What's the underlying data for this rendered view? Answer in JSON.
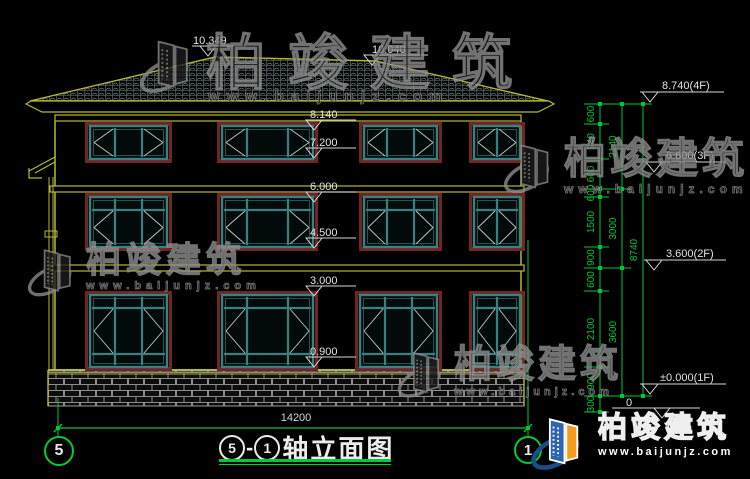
{
  "brand": {
    "name": "柏竣建筑",
    "url": "www.baijunjz.com"
  },
  "title": {
    "axis_from": "5",
    "dash": "-",
    "axis_to": "1",
    "name": "轴立面图"
  },
  "axes": {
    "left_label": "5",
    "right_label": "1"
  },
  "bottom_dim": {
    "label": "14200"
  },
  "figure": {
    "colors": {
      "yellow": "#b8b832",
      "teal": "#3a8080",
      "teal_dark": "#235555",
      "red": "#722323",
      "green": "#00c832",
      "white": "#d8d8d8",
      "text": "#e2e2e2"
    },
    "levels_left": [
      {
        "label": "10.349",
        "tx": 193,
        "ty": 34,
        "lx1": 192,
        "lx2": 246,
        "ly": 46,
        "ax": 208
      },
      {
        "label": "10.040",
        "tx": 372,
        "ty": 43,
        "lx1": 370,
        "lx2": 428,
        "ly": 55,
        "ax": 372
      },
      {
        "label": "8.140",
        "tx": 310,
        "ty": 108,
        "lx1": 308,
        "lx2": 356,
        "ly": 120,
        "ax": 314
      },
      {
        "label": "7.200",
        "tx": 310,
        "ty": 136,
        "lx1": 308,
        "lx2": 356,
        "ly": 148,
        "ax": 314
      },
      {
        "label": "6.000",
        "tx": 310,
        "ty": 180,
        "lx1": 308,
        "lx2": 356,
        "ly": 192,
        "ax": 314
      },
      {
        "label": "4.500",
        "tx": 310,
        "ty": 226,
        "lx1": 308,
        "lx2": 356,
        "ly": 238,
        "ax": 314
      },
      {
        "label": "3.000",
        "tx": 310,
        "ty": 274,
        "lx1": 308,
        "lx2": 356,
        "ly": 286,
        "ax": 314
      },
      {
        "label": "0.900",
        "tx": 310,
        "ty": 345,
        "lx1": 308,
        "lx2": 356,
        "ly": 357,
        "ax": 314
      }
    ],
    "levels_right": [
      {
        "label": "8.740(4F)",
        "tx": 662,
        "ty": 79,
        "lx1": 640,
        "lx2": 724,
        "ly": 92,
        "ax": 650
      },
      {
        "label": "6.600(3F)",
        "tx": 666,
        "ty": 149,
        "lx1": 644,
        "lx2": 726,
        "ly": 162,
        "ax": 654
      },
      {
        "label": "3.600(2F)",
        "tx": 666,
        "ty": 247,
        "lx1": 644,
        "lx2": 726,
        "ly": 260,
        "ax": 654
      },
      {
        "label": "±0.000(1F)",
        "tx": 660,
        "ty": 371,
        "lx1": 640,
        "lx2": 726,
        "ly": 384,
        "ax": 650
      },
      {
        "label": "0",
        "tx": 626,
        "ty": 396,
        "lx1": 612,
        "lx2": 700,
        "ly": 408,
        "ax": 662
      }
    ],
    "chain": {
      "cols": [
        {
          "x": 600
        },
        {
          "x": 622
        },
        {
          "x": 643
        }
      ],
      "segments": [
        {
          "col": 0,
          "label": "600",
          "y1": 104,
          "y2": 124
        },
        {
          "col": 0,
          "label": "940",
          "y1": 124,
          "y2": 159
        },
        {
          "col": 0,
          "label": "600",
          "y1": 159,
          "y2": 189
        },
        {
          "col": 0,
          "label": "600",
          "y1": 189,
          "y2": 197
        },
        {
          "col": 0,
          "label": "1500",
          "y1": 197,
          "y2": 247
        },
        {
          "col": 0,
          "label": "900",
          "y1": 247,
          "y2": 268
        },
        {
          "col": 0,
          "label": "600",
          "y1": 268,
          "y2": 291
        },
        {
          "col": 0,
          "label": "2100",
          "y1": 291,
          "y2": 367
        },
        {
          "col": 0,
          "label": "900",
          "y1": 367,
          "y2": 396
        },
        {
          "col": 0,
          "label": "300",
          "y1": 396,
          "y2": 412
        },
        {
          "col": 1,
          "label": "2140",
          "y1": 104,
          "y2": 189
        },
        {
          "col": 1,
          "label": "3000",
          "y1": 189,
          "y2": 268
        },
        {
          "col": 1,
          "label": "3600",
          "y1": 268,
          "y2": 396
        },
        {
          "col": 2,
          "label": "8740",
          "y1": 104,
          "y2": 396
        }
      ]
    },
    "bottom_dim_geom": {
      "x1": 58,
      "x2": 528,
      "y": 428
    },
    "axis_lines": [
      {
        "x": 58,
        "y1": 398,
        "y2": 436
      },
      {
        "x": 528,
        "y1": 240,
        "y2": 436
      }
    ],
    "windows": [
      {
        "x": 90,
        "y": 126,
        "w": 77,
        "h": 33,
        "cols": [
          0.33,
          0.67
        ],
        "rows": "plain"
      },
      {
        "x": 222,
        "y": 126,
        "w": 91,
        "h": 33,
        "cols": [
          0.27,
          0.73
        ],
        "rows": "plain"
      },
      {
        "x": 364,
        "y": 126,
        "w": 73,
        "h": 33,
        "cols": [
          0.32,
          0.68
        ],
        "rows": "plain"
      },
      {
        "x": 474,
        "y": 126,
        "w": 46,
        "h": 33,
        "cols": [
          0.5
        ],
        "rows": "plain"
      },
      {
        "x": 90,
        "y": 197,
        "w": 77,
        "h": 50,
        "cols": [
          0.33,
          0.67
        ],
        "rows": "transom"
      },
      {
        "x": 222,
        "y": 197,
        "w": 91,
        "h": 50,
        "cols": [
          0.27,
          0.73
        ],
        "rows": "transom"
      },
      {
        "x": 364,
        "y": 197,
        "w": 73,
        "h": 50,
        "cols": [
          0.32,
          0.68
        ],
        "rows": "transom"
      },
      {
        "x": 474,
        "y": 197,
        "w": 46,
        "h": 50,
        "cols": [
          0.5
        ],
        "rows": "transom"
      },
      {
        "x": 90,
        "y": 295,
        "w": 77,
        "h": 72,
        "cols": [
          0.33,
          0.67
        ],
        "rows": "full"
      },
      {
        "x": 222,
        "y": 295,
        "w": 91,
        "h": 72,
        "cols": [
          0.27,
          0.73
        ],
        "rows": "full"
      },
      {
        "x": 360,
        "y": 295,
        "w": 77,
        "h": 72,
        "cols": [
          0.32,
          0.68
        ],
        "rows": "full"
      },
      {
        "x": 474,
        "y": 295,
        "w": 46,
        "h": 72,
        "cols": [
          0.5
        ],
        "rows": "full"
      }
    ]
  }
}
